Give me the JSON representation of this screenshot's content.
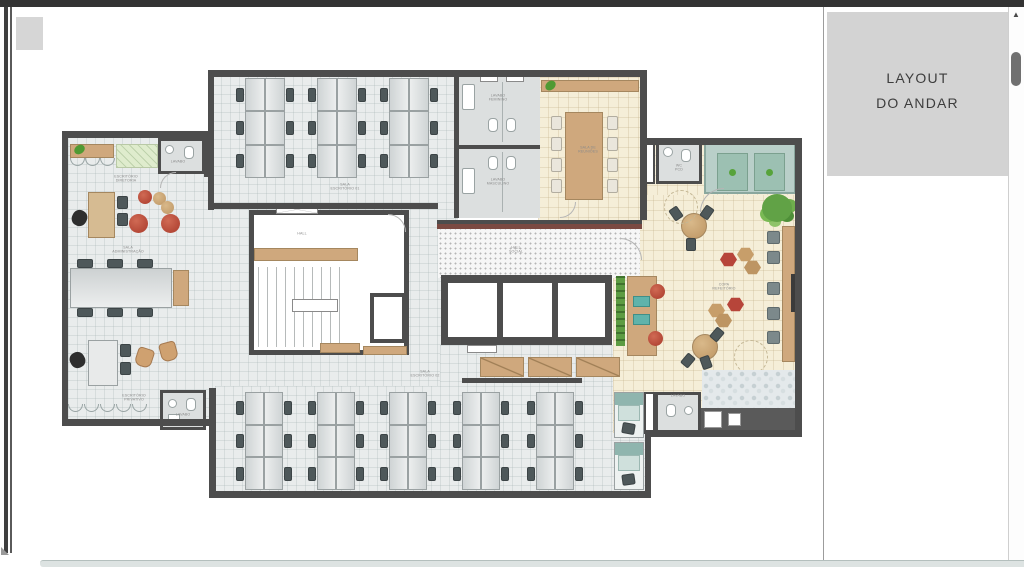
{
  "window": {
    "right_panel": {
      "title_line1": "LAYOUT",
      "title_line2": "DO ANDAR"
    }
  },
  "plan_labels": {
    "top_office": {
      "l1": "SALA",
      "l2": "ESCRITÓRIO 01"
    },
    "bottom_office": {
      "l1": "SALA",
      "l2": "ESCRITÓRIO 02"
    },
    "admin_room": {
      "l1": "SALA",
      "l2": "ADMINISTRAÇÃO"
    },
    "office_top_left": {
      "l1": "ESCRITÓRIO",
      "l2": "DIRETORIA"
    },
    "office_bottom_left": {
      "l1": "ESCRITÓRIO",
      "l2": "PRIVATIVO"
    },
    "meeting_room": {
      "l1": "SALA DE",
      "l2": "REUNIÕES"
    },
    "copa": {
      "l1": "COPA",
      "l2": "REFEITÓRIO"
    },
    "hall_social": {
      "l1": "HALL",
      "l2": "SOCIAL"
    },
    "hall_core": {
      "l1": "HALL",
      "l2": ""
    },
    "lavabo_fem": {
      "l1": "LAVABO",
      "l2": "FEMININO"
    },
    "lavabo_masc": {
      "l1": "LAVABO",
      "l2": "MASCULINO"
    },
    "lavabo_top_left": {
      "l1": "LAVABO",
      "l2": ""
    },
    "lavabo_bottom_left": {
      "l1": "LAVABO",
      "l2": ""
    },
    "lavabo_bottom_right": {
      "l1": "LAVABO",
      "l2": ""
    },
    "wc_pcd": {
      "l1": "WC",
      "l2": "PCD"
    }
  },
  "icons": {
    "scroll_up_arrow": "▲"
  },
  "colors": {
    "wall": "#4d4d4d",
    "floor": "#e9ecec",
    "beige": "#f5eed8",
    "wood": "#cfa87d",
    "desk1": "#cfd4d5",
    "desk2": "#eceeee",
    "deskBorder": "#9aa1a2",
    "chair": "#4e585a",
    "red": "#b23a34",
    "tan": "#c79e6a",
    "teal": "#a9c6c0",
    "green": "#69a84f",
    "restroom": "#dcdfdf",
    "topbar": "#333333",
    "bottombar": "#dde3e2",
    "panel": "#d3d3d3",
    "thumb": "#707070",
    "label": "#8a8a8a",
    "hallband": "#7b4a42"
  }
}
